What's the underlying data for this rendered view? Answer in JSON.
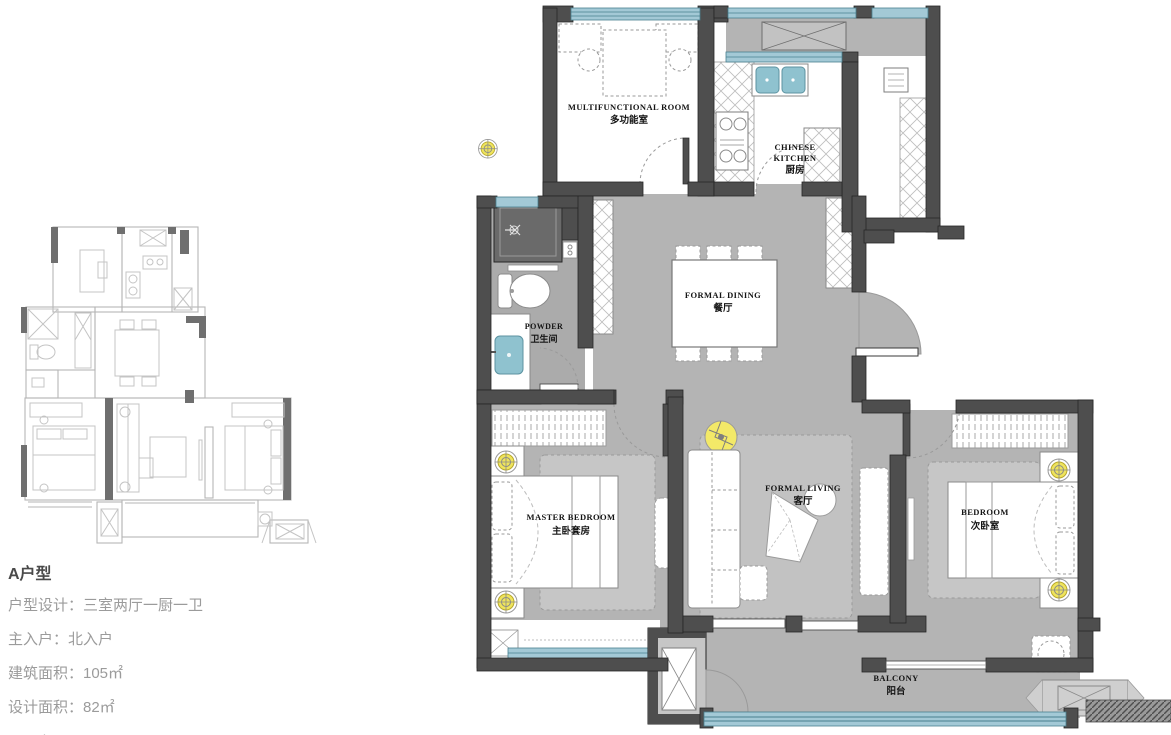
{
  "info_panel": {
    "title": "A户型",
    "lines": [
      "户型设计：三室两厅一厨一卫",
      "主入户：北入户",
      "建筑面积：105㎡",
      "设计面积：82㎡"
    ],
    "caption": "平面布置图 / FURNITURE&FURNISHING LEVEL"
  },
  "floor_plan": {
    "rooms": {
      "multifunctional": {
        "en": "MULTIFUNCTIONAL ROOM",
        "zh": "多功能室"
      },
      "kitchen": {
        "en1": "CHINESE",
        "en2": "KITCHEN",
        "zh": "厨房"
      },
      "dining": {
        "en": "FORMAL DINING",
        "zh": "餐厅"
      },
      "powder": {
        "en": "POWDER",
        "zh": "卫生间"
      },
      "master_bedroom": {
        "en": "MASTER BEDROOM",
        "zh": "主卧套房"
      },
      "living": {
        "en": "FORMAL LIVING",
        "zh": "客厅"
      },
      "bedroom": {
        "en": "BEDROOM",
        "zh": "次卧室"
      },
      "balcony": {
        "en": "BALCONY",
        "zh": "阳台"
      }
    },
    "colors": {
      "wall": "#4e4e4e",
      "floor": "#b4b4b4",
      "floor_light": "#c6c6c6",
      "window_glass": "#a3c9d6",
      "window_line": "#49808f",
      "lamp_yellow": "#efe45c",
      "fixture_teal": "#8fc2cf",
      "mini_line": "#b6b6b6",
      "mini_wall": "#6f6f6f"
    }
  }
}
